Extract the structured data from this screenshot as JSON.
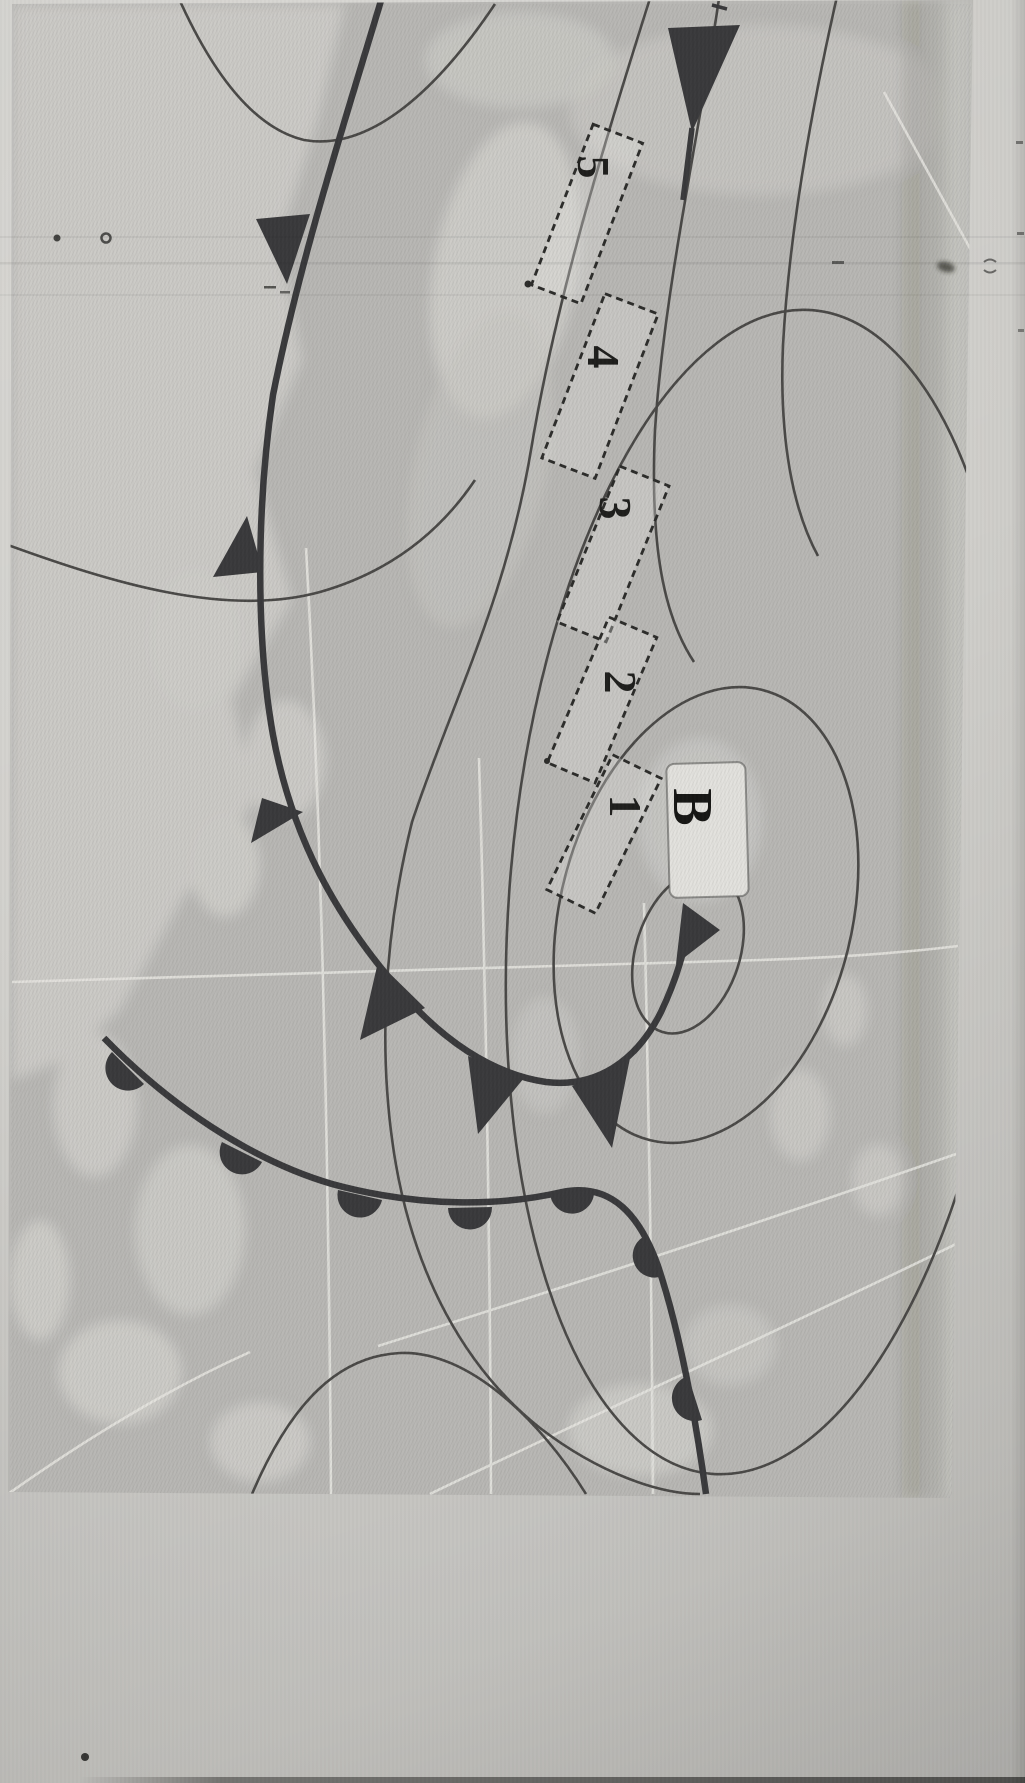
{
  "map": {
    "low_pressure_label": "B",
    "zones": [
      {
        "label": "1"
      },
      {
        "label": "2"
      },
      {
        "label": "3"
      },
      {
        "label": "4"
      },
      {
        "label": "5"
      }
    ],
    "symbols": {
      "cold_front": "filled-triangle",
      "warm_front": "filled-semicircle"
    },
    "colors": {
      "paper": "#d4d2ce",
      "sea": "#b9b8b5",
      "land": "#cbcac6",
      "front_ink": "#3a3a3c",
      "isobar_ink": "#4b4a48",
      "grid_line": "#e6e5e1",
      "label_ink": "#1f1f1d",
      "label_box_fill": "#e3e2de"
    }
  }
}
